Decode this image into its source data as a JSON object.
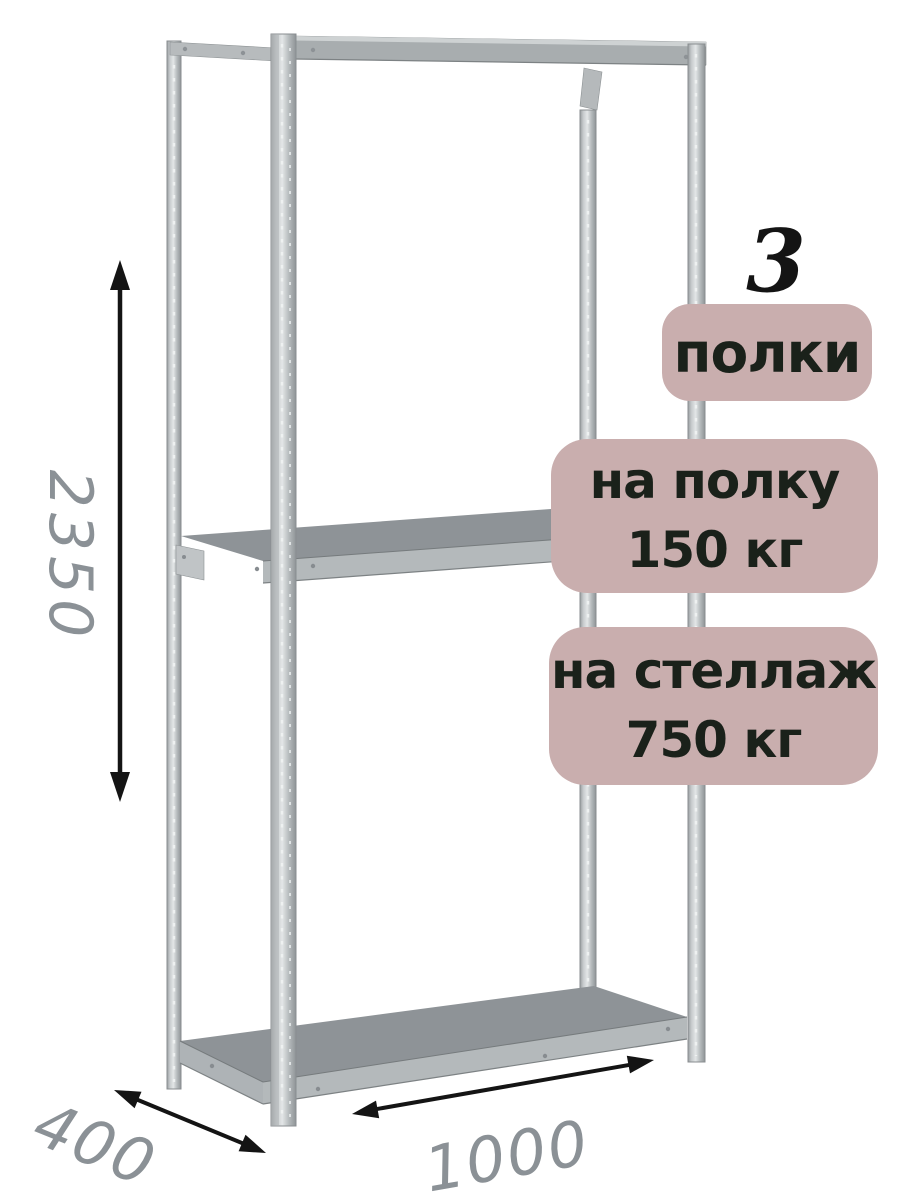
{
  "product": {
    "illustration": "metal-shelving-rack-3-shelves",
    "shelf_count": "3",
    "badges": {
      "shelves": {
        "label": "полки"
      },
      "per_shelf": {
        "line1": "на полку",
        "line2": "150 кг"
      },
      "per_rack": {
        "line1": "на стеллаж",
        "line2": "750 кг"
      }
    },
    "dimensions": {
      "height_mm": "2350",
      "depth_mm": "400",
      "width_mm": "1000"
    }
  },
  "colors": {
    "badge_background": "#c9aeae",
    "badge_text": "#1a211a",
    "dimension_text": "#8b9196",
    "arrow": "#141414",
    "metal_light": "#d8dbdc",
    "metal_dark": "#8e9397",
    "background": "#ffffff"
  }
}
